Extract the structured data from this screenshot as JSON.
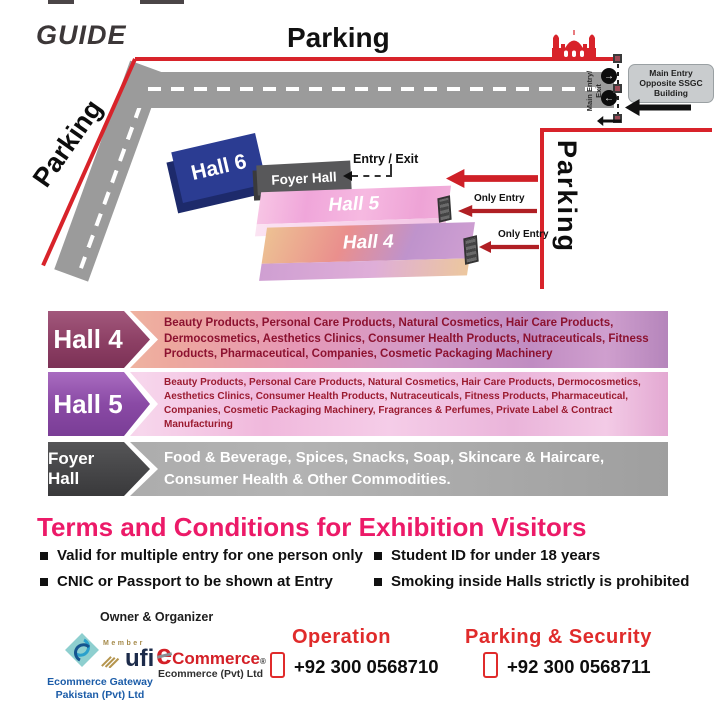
{
  "map": {
    "guide_label": "GUIDE",
    "parking_top_label": "Parking",
    "parking_left_label": "Parking",
    "parking_right_label": "Parking",
    "main_entry_exit_label": "Main Entry/ Exit",
    "main_entry_box_text": "Main Entry Opposite SSGC Building",
    "entry_exit_label": "Entry / Exit",
    "only_entry_label_1": "Only Entry",
    "only_entry_label_2": "Only Entry",
    "hall6_label": "Hall 6",
    "foyer_label": "Foyer Hall",
    "hall5_label": "Hall 5",
    "hall4_label": "Hall 4"
  },
  "icons": {
    "circle_arrow_right": "→",
    "circle_arrow_left": "←"
  },
  "legend": [
    {
      "name": "Hall 4",
      "description": "Beauty Products, Personal Care Products, Natural Cosmetics, Hair Care Products, Dermocosmetics, Aesthetics Clinics, Consumer Health Products, Nutraceuticals, Fitness Products, Pharmaceutical, Companies, Cosmetic Packaging Machinery"
    },
    {
      "name": "Hall 5",
      "description": "Beauty Products, Personal Care Products, Natural Cosmetics, Hair Care Products, Dermocosmetics, Aesthetics Clinics, Consumer Health Products, Nutraceuticals, Fitness Products, Pharmaceutical, Companies, Cosmetic Packaging Machinery, Fragrances & Perfumes, Private Label & Contract Manufacturing"
    },
    {
      "name": "Foyer Hall",
      "description": "Food & Beverage, Spices, Snacks, Soap, Skincare & Haircare, Consumer Health & Other Commodities."
    }
  ],
  "terms": {
    "title": "Terms and Conditions for Exhibition Visitors",
    "column1": [
      "Valid for multiple entry for one person only",
      "CNIC or Passport to be shown at Entry"
    ],
    "column2": [
      "Student ID for under 18 years",
      "Smoking inside Halls strictly is prohibited"
    ]
  },
  "footer": {
    "owner_organizer_label": "Owner & Organizer",
    "egp_caption": "Ecommerce Gateway Pakistan (Pvt) Ltd",
    "ufi_member_label": "Member",
    "ufi_name": "ufi",
    "ecommerce_e": "e",
    "ecommerce_name": "Commerce",
    "ecommerce_reg": "®",
    "ecommerce_caption": "Ecommerce (Pvt) Ltd",
    "operation": {
      "label": "Operation",
      "phone": "+92 300 0568710"
    },
    "parking_security": {
      "label": "Parking & Security",
      "phone": "+92 300 0568711"
    }
  },
  "colors": {
    "accent_red": "#d8232a",
    "heading_pink": "#ec1a68",
    "hall4_plum": "#8c3f64",
    "hall5_purple": "#8a4aa5",
    "foyer_charcoal": "#3f3f41",
    "hall6_blue": "#2b3c92",
    "road_gray": "#9b9b9b"
  }
}
